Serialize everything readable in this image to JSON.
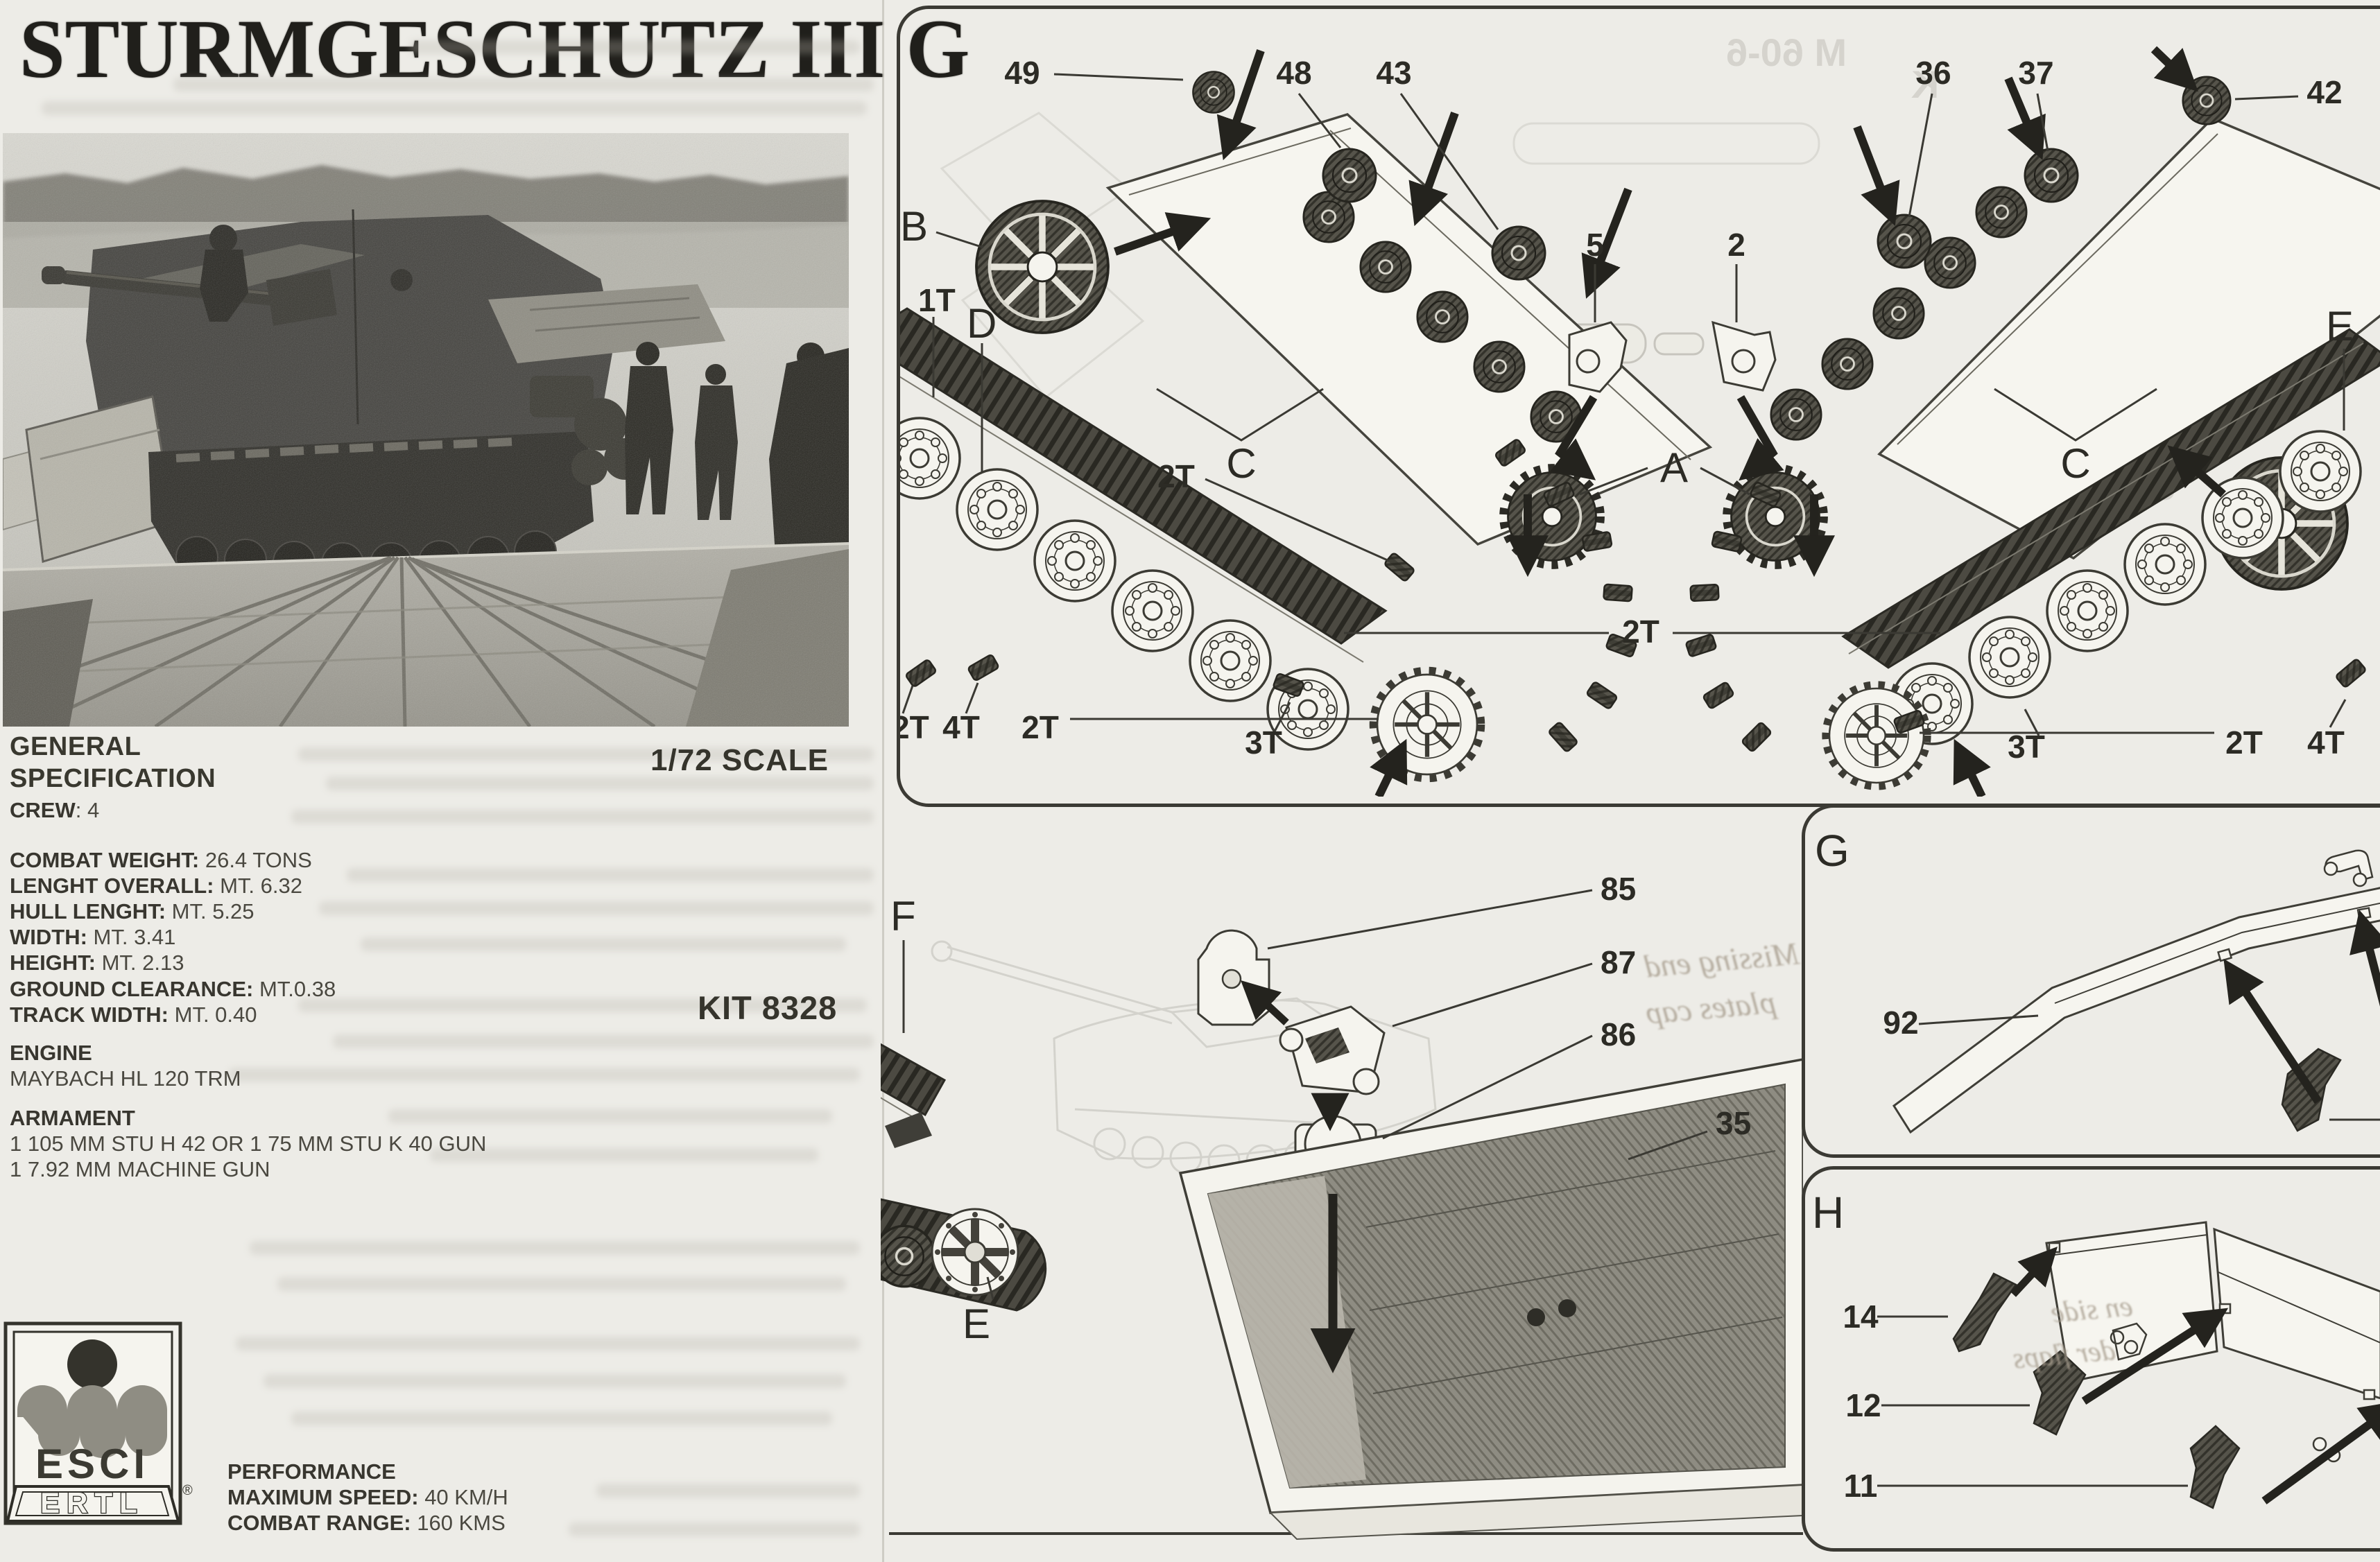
{
  "title": "STURMGESCHUTZ III G",
  "left_page": {
    "scale_label": "1/72 SCALE",
    "kit_label": "KIT 8328",
    "spec": {
      "heading1": "GENERAL",
      "heading2": "SPECIFICATION",
      "crew_label": "CREW",
      "crew_value": ": 4",
      "dims": [
        {
          "label": "COMBAT WEIGHT:",
          "value": " 26.4 TONS"
        },
        {
          "label": "LENGHT OVERALL:",
          "value": " MT. 6.32"
        },
        {
          "label": "HULL LENGHT:",
          "value": " MT. 5.25"
        },
        {
          "label": "WIDTH:",
          "value": " MT. 3.41"
        },
        {
          "label": "HEIGHT:",
          "value": " MT. 2.13"
        }
      ],
      "clearance": [
        {
          "label": "GROUND CLEARANCE:",
          "value": " MT.0.38"
        },
        {
          "label": "TRACK WIDTH:",
          "value": " MT. 0.40"
        }
      ],
      "engine_heading": "ENGINE",
      "engine_value": "MAYBACH HL 120 TRM",
      "armament_heading": "ARMAMENT",
      "armament_line1": "1 105 MM STU H 42 OR 1 75 MM STU K 40 GUN",
      "armament_line2": "1 7.92 MM MACHINE GUN",
      "performance_heading": "PERFORMANCE",
      "performance": [
        {
          "label": "MAXIMUM SPEED:",
          "value": " 40 KM/H"
        },
        {
          "label": "COMBAT RANGE:",
          "value": " 160 KMS"
        }
      ]
    },
    "logo": {
      "brand_top": "ESCI",
      "brand_bottom": "ERTL",
      "registered": "®"
    }
  },
  "diagram": {
    "top_panel": {
      "num_49": "49",
      "num_48": "48",
      "num_43": "43",
      "num_36": "36",
      "num_37": "37",
      "num_42": "42",
      "letter_b": "B",
      "label_1t": "1T",
      "letter_d": "D",
      "num_5": "5",
      "num_2": "2",
      "letter_a": "A",
      "letter_c_left": "C",
      "letter_c_right": "C",
      "letter_e": "E",
      "t2_upper": "2T",
      "t2_center": "2T",
      "t2_left_edge": "2T",
      "t4_left": "4T",
      "t2_left": "2T",
      "t3_left": "3T",
      "t3_right": "3T",
      "t2_right": "2T",
      "t4_right": "4T"
    },
    "middle_panel": {
      "letter_f": "F",
      "letter_e": "E",
      "num_85": "85",
      "num_87": "87",
      "num_86": "86",
      "num_35": "35"
    },
    "panel_g": {
      "letter": "G",
      "num_92": "92"
    },
    "panel_h": {
      "letter": "H",
      "num_14": "14",
      "num_12": "12",
      "num_11": "11"
    },
    "notes": {
      "note1_line1": "Missing end",
      "note1_line2": "plates cap",
      "note2_line1": "en side",
      "note2_line2": "der flaps"
    },
    "bleed": {
      "m": "M 60-6",
      "k": "K",
      "n82": "82",
      "n3432": "34   32",
      "h_ghost": "H"
    }
  }
}
